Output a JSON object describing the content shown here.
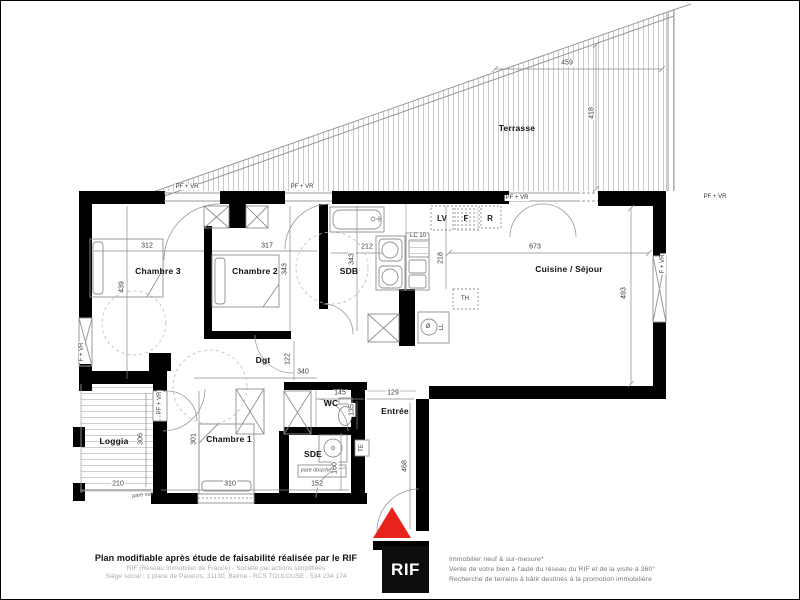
{
  "rooms": {
    "terrasse": {
      "name": "Terrasse"
    },
    "chambre3": {
      "name": "Chambre 3",
      "w": "312",
      "h": "439"
    },
    "chambre2": {
      "name": "Chambre 2",
      "w": "317",
      "h": "343"
    },
    "sdb": {
      "name": "SDB",
      "w": "212",
      "h": "343"
    },
    "cuisine": {
      "name": "Cuisine / Séjour",
      "w": "673",
      "h": "493"
    },
    "dgt": {
      "name": "Dgt",
      "w": "340",
      "h": "122"
    },
    "wc": {
      "name": "WC",
      "w": "145",
      "h": "135"
    },
    "entree": {
      "name": "Entrée",
      "w": "129",
      "h": "468"
    },
    "chambre1": {
      "name": "Chambre 1",
      "w": "310",
      "h": "301"
    },
    "sde": {
      "name": "SDE",
      "w": "152",
      "h": "160"
    },
    "loggia": {
      "name": "Loggia",
      "w": "210",
      "h": "306"
    }
  },
  "terrasse_dims": {
    "w": "459",
    "h": "418"
  },
  "kitchen_counter_depth": "218",
  "tags": {
    "pf_vr": "PF + VR",
    "f_vr": "F + VR",
    "lv": "LV",
    "four": "F",
    "refrigerateur": "R",
    "ll": "LL",
    "th": "TH",
    "te": "TE",
    "lc10": "LC 10",
    "pare_douche": "pare douche",
    "pare_vue": "pare vue",
    "diameter": "Ø"
  },
  "colors": {
    "wall": "#000000",
    "entry_arrow": "#e6241c",
    "line": "#999999"
  },
  "footer": {
    "title": "Plan modifiable après étude de faisabilité réalisée par le RIF",
    "line1": "RIF (Réseau Immobilier de France) - Société par actions simplifiées",
    "line2": "Siège social : 1 place de Paveurs, 31130, Balma - RCS TOULOUSE : 534 234 174",
    "logo": "RIF",
    "tagline1": "Immobilier neuf & sur-mesure*",
    "tagline2": "Vente de votre bien à l'aide du réseau du RIF et de la visite à 360°",
    "tagline3": "Recherche de terrains à bâtir destinés à la promotion immobilière"
  }
}
